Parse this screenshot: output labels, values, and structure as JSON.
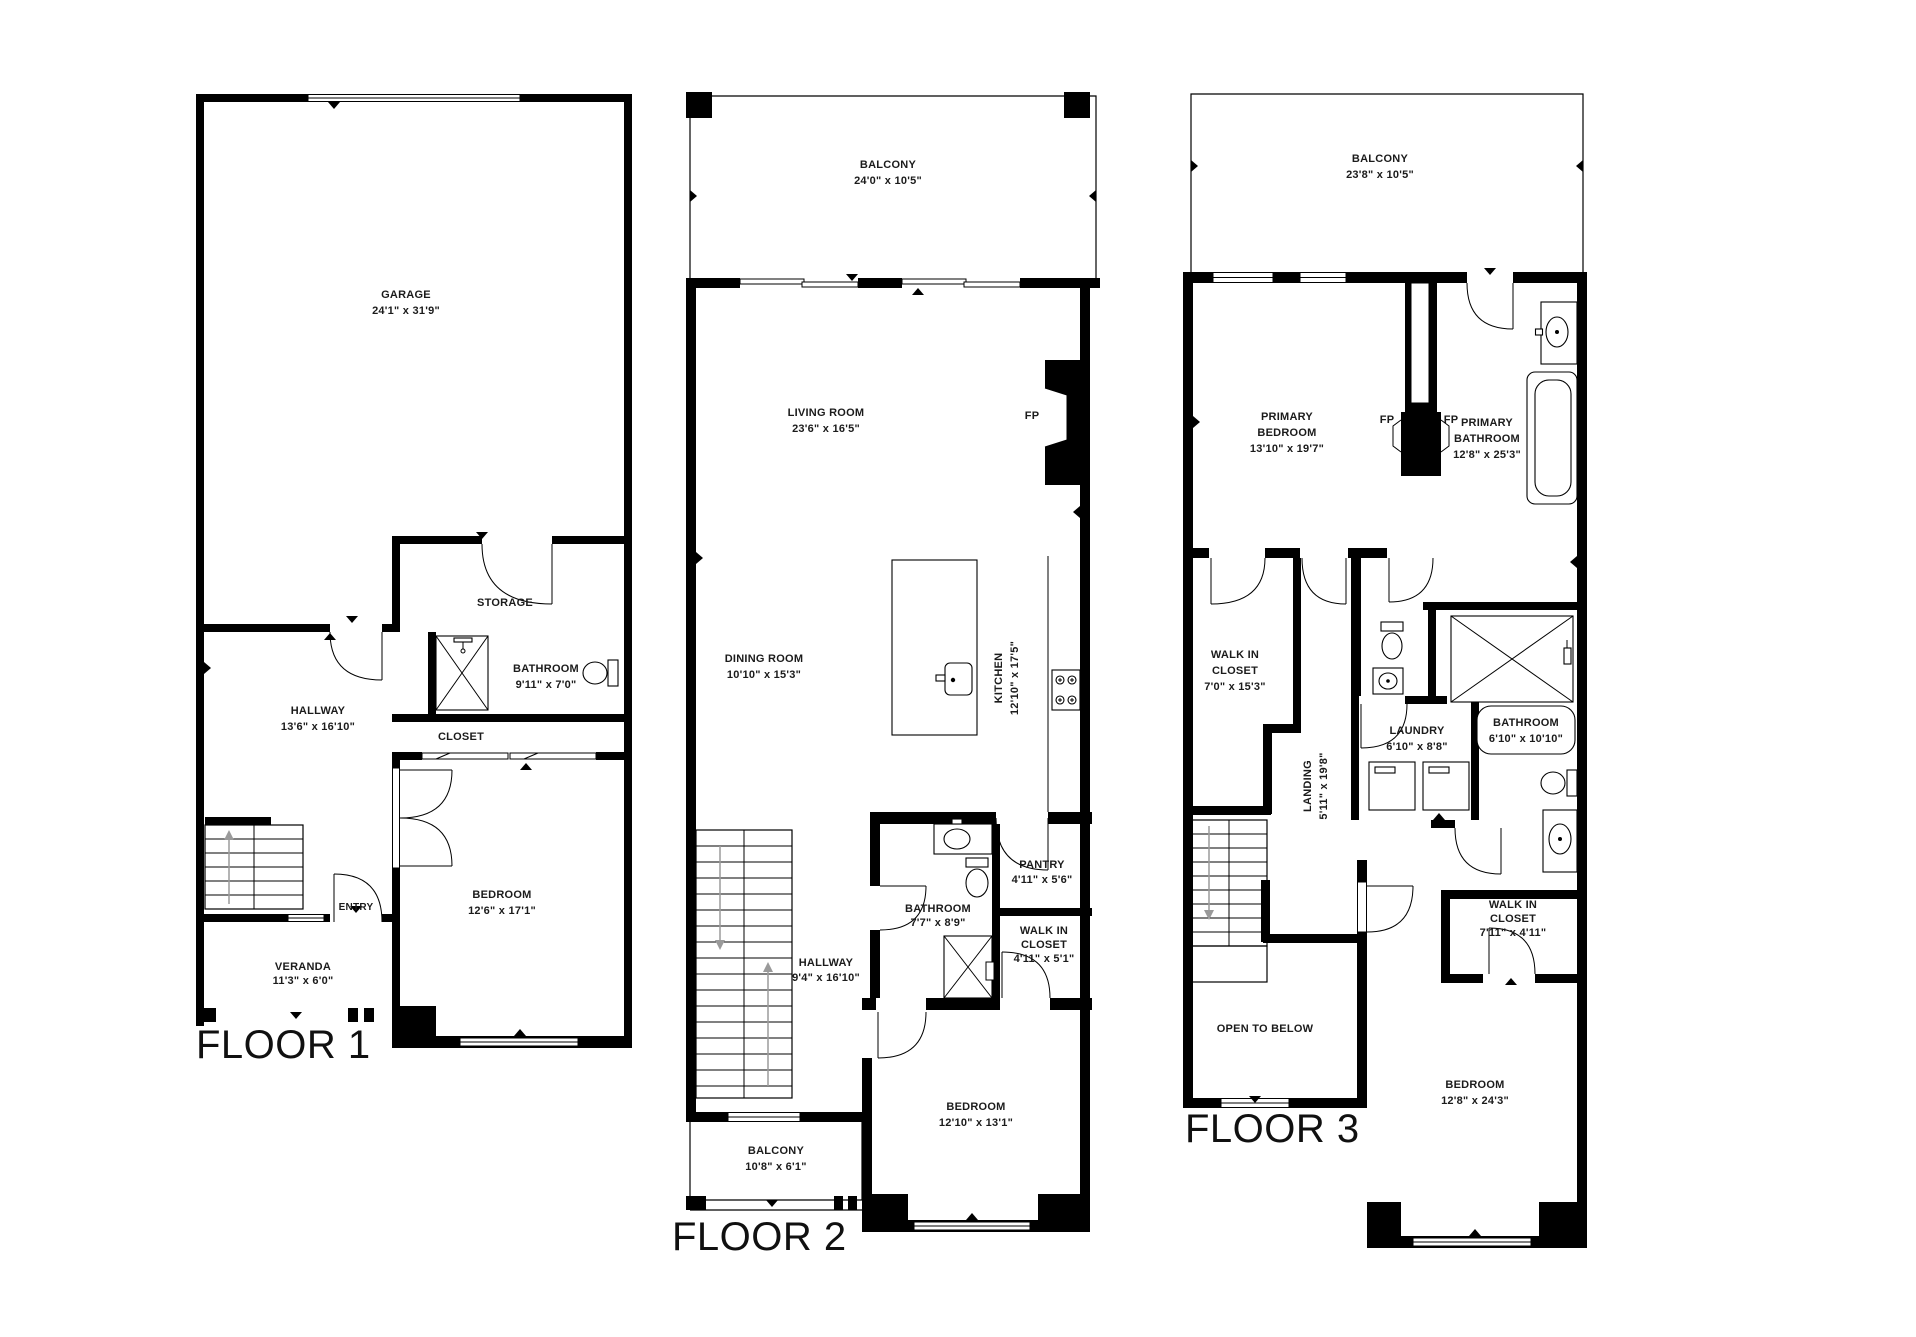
{
  "colors": {
    "wall": "#000000",
    "background": "#ffffff",
    "stair_arrow": "#9a9a9a"
  },
  "floors": [
    {
      "label": "FLOOR 1",
      "rooms": {
        "garage": {
          "lines": [
            "GARAGE",
            "24'1\" x 31'9\""
          ]
        },
        "storage": {
          "lines": [
            "STORAGE"
          ]
        },
        "hallway": {
          "lines": [
            "HALLWAY",
            "13'6\" x 16'10\""
          ]
        },
        "bathroom": {
          "lines": [
            "BATHROOM",
            "9'11\" x 7'0\""
          ]
        },
        "closet": {
          "lines": [
            "CLOSET"
          ]
        },
        "bedroom": {
          "lines": [
            "BEDROOM",
            "12'6\" x 17'1\""
          ]
        },
        "entry": {
          "lines": [
            "ENTRY"
          ]
        },
        "veranda": {
          "lines": [
            "VERANDA",
            "11'3\" x 6'0\""
          ]
        }
      }
    },
    {
      "label": "FLOOR 2",
      "rooms": {
        "balcony_top": {
          "lines": [
            "BALCONY",
            "24'0\" x 10'5\""
          ]
        },
        "living_room": {
          "lines": [
            "LIVING ROOM",
            "23'6\" x 16'5\""
          ]
        },
        "fireplace": {
          "lines": [
            "FP"
          ]
        },
        "dining_room": {
          "lines": [
            "DINING ROOM",
            "10'10\" x 15'3\""
          ]
        },
        "kitchen": {
          "lines": [
            "KITCHEN",
            "12'10\" x 17'5\""
          ]
        },
        "bathroom": {
          "lines": [
            "BATHROOM",
            "7'7\" x 8'9\""
          ]
        },
        "pantry": {
          "lines": [
            "PANTRY",
            "4'11\" x 5'6\""
          ]
        },
        "walk_in_closet": {
          "lines": [
            "WALK IN",
            "CLOSET",
            "4'11\" x 5'1\""
          ]
        },
        "hallway": {
          "lines": [
            "HALLWAY",
            "9'4\" x 16'10\""
          ]
        },
        "bedroom": {
          "lines": [
            "BEDROOM",
            "12'10\" x 13'1\""
          ]
        },
        "balcony_bottom": {
          "lines": [
            "BALCONY",
            "10'8\" x 6'1\""
          ]
        }
      }
    },
    {
      "label": "FLOOR 3",
      "rooms": {
        "balcony": {
          "lines": [
            "BALCONY",
            "23'8\" x 10'5\""
          ]
        },
        "primary_bedroom": {
          "lines": [
            "PRIMARY",
            "BEDROOM",
            "13'10\" x 19'7\""
          ]
        },
        "fireplace_left": {
          "lines": [
            "FP"
          ]
        },
        "fireplace_right": {
          "lines": [
            "FP"
          ]
        },
        "primary_bathroom": {
          "lines": [
            "PRIMARY",
            "BATHROOM",
            "12'8\" x 25'3\""
          ]
        },
        "walk_in_closet_top": {
          "lines": [
            "WALK IN",
            "CLOSET",
            "7'0\" x 15'3\""
          ]
        },
        "landing": {
          "lines": [
            "LANDING",
            "5'11\" x 19'8\""
          ]
        },
        "laundry": {
          "lines": [
            "LAUNDRY",
            "6'10\" x 8'8\""
          ]
        },
        "bathroom": {
          "lines": [
            "BATHROOM",
            "6'10\" x 10'10\""
          ]
        },
        "open_to_below": {
          "lines": [
            "OPEN TO BELOW"
          ]
        },
        "bedroom": {
          "lines": [
            "BEDROOM",
            "12'8\" x 24'3\""
          ]
        },
        "walk_in_closet_bottom": {
          "lines": [
            "WALK IN",
            "CLOSET",
            "7'11\" x 4'11\""
          ]
        }
      }
    }
  ]
}
